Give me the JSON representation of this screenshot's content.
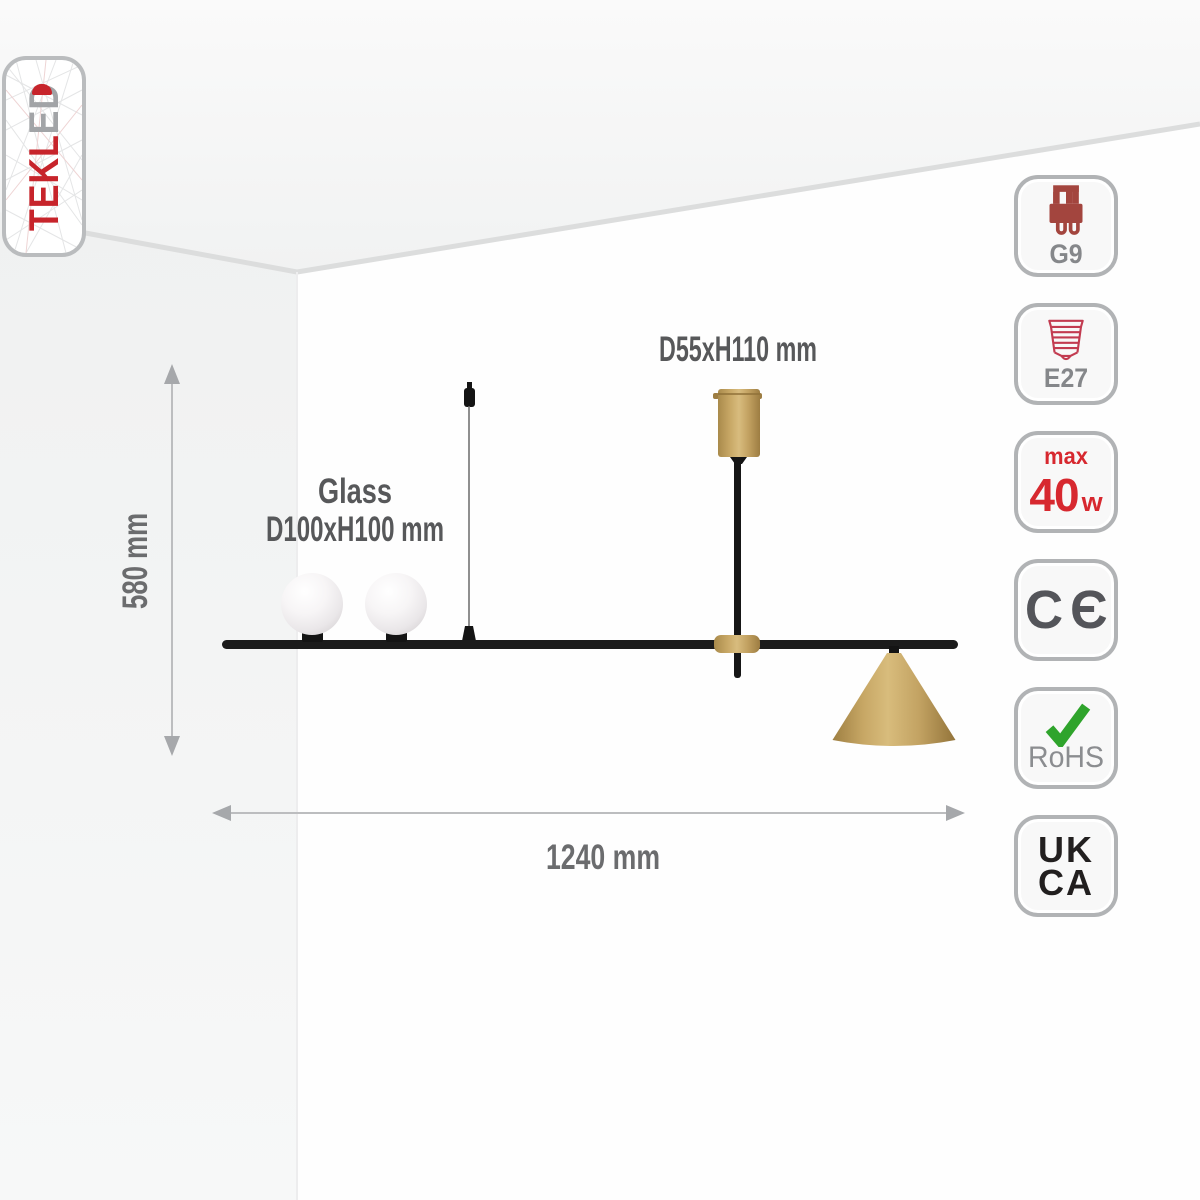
{
  "logo": {
    "text_red": "TEKL",
    "text_gray": "ED",
    "red_color": "#c7242b",
    "gray_color": "#a2a4a7"
  },
  "diagram": {
    "canopy_dim_label": "D55xH110 mm",
    "glass_label": "Glass",
    "glass_dim_label": "D100xH100 mm",
    "height_label": "580 mm",
    "width_label": "1240 mm",
    "gold_color": "#c4a565",
    "black_color": "#1b1b1b",
    "glass_color": "#efecee"
  },
  "badges": {
    "g9": {
      "label": "G9",
      "icon": "g9-capsule-socket-icon",
      "icon_color": "#a3453e"
    },
    "e27": {
      "label": "E27",
      "icon": "e27-screw-base-icon",
      "icon_color": "#c23b50"
    },
    "wattage": {
      "prefix": "max",
      "value": "40",
      "unit": "w",
      "color": "#d7282f"
    },
    "ce": {
      "label": "CЄ"
    },
    "rohs": {
      "label": "RoHS",
      "icon": "green-checkmark-icon",
      "icon_color": "#2fa42c"
    },
    "ukca": {
      "line1": "UK",
      "line2": "CA"
    }
  }
}
